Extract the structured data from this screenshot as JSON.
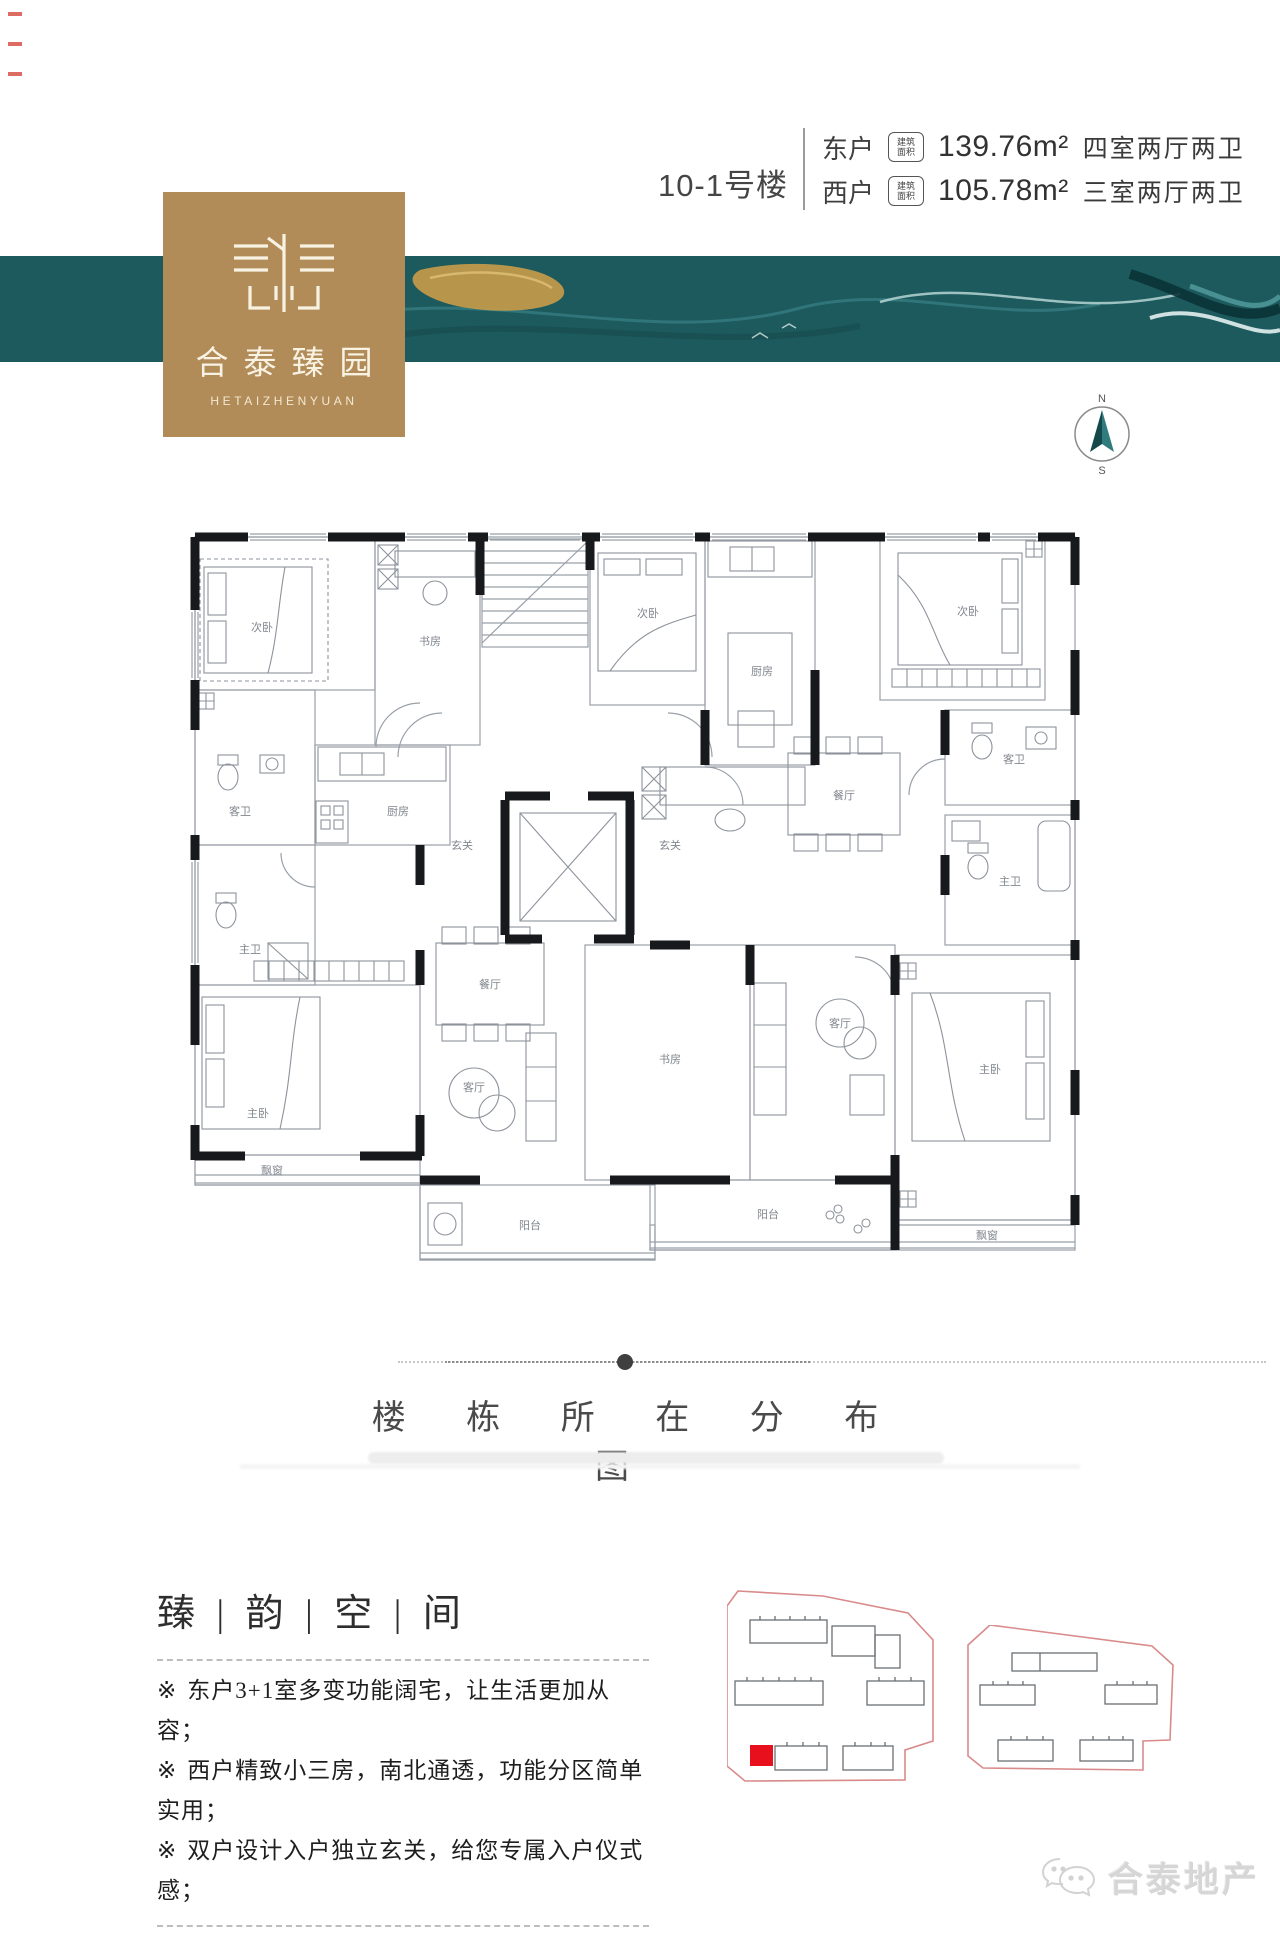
{
  "header": {
    "building_label": "10-1号楼",
    "area_badge": {
      "line1": "建筑",
      "line2": "面积",
      "dot": "m"
    },
    "units": [
      {
        "name": "东户",
        "area": "139.76m²",
        "layout": "四室两厅两卫"
      },
      {
        "name": "西户",
        "area": "105.78m²",
        "layout": "三室两厅两卫"
      }
    ]
  },
  "logo": {
    "name_cn": "合泰臻园",
    "name_en": "HETAIZHENYUAN"
  },
  "compass": {
    "north": "N",
    "south": "S"
  },
  "floorplan": {
    "rooms": [
      {
        "id": "w-bedroom2",
        "label": "次卧"
      },
      {
        "id": "w-study",
        "label": "书房"
      },
      {
        "id": "w-guest-bath",
        "label": "客卫"
      },
      {
        "id": "w-kitchen",
        "label": "厨房"
      },
      {
        "id": "w-master-bath",
        "label": "主卫"
      },
      {
        "id": "w-master-bedroom",
        "label": "主卧"
      },
      {
        "id": "w-bay-window",
        "label": "飘窗"
      },
      {
        "id": "w-dining",
        "label": "餐厅"
      },
      {
        "id": "w-living",
        "label": "客厅"
      },
      {
        "id": "w-balcony",
        "label": "阳台"
      },
      {
        "id": "w-foyer",
        "label": "玄关"
      },
      {
        "id": "e-foyer",
        "label": "玄关"
      },
      {
        "id": "e-bedroom2",
        "label": "次卧"
      },
      {
        "id": "e-kitchen",
        "label": "厨房"
      },
      {
        "id": "e-bedroom3",
        "label": "次卧"
      },
      {
        "id": "e-dining",
        "label": "餐厅"
      },
      {
        "id": "e-guest-bath",
        "label": "客卫"
      },
      {
        "id": "e-master-bath",
        "label": "主卫"
      },
      {
        "id": "e-study",
        "label": "书房"
      },
      {
        "id": "e-living",
        "label": "客厅"
      },
      {
        "id": "e-master-bedroom",
        "label": "主卧"
      },
      {
        "id": "e-bay-window",
        "label": "飘窗"
      },
      {
        "id": "e-balcony",
        "label": "阳台"
      }
    ]
  },
  "section": {
    "title": "楼 栋 所 在 分 布 图"
  },
  "features": {
    "heading": "臻 | 韵 | 空 | 间",
    "bullet": "※",
    "items": [
      "东户3+1室多变功能阔宅，让生活更加从容；",
      "西户精致小三房，南北通透，功能分区简单实用；",
      "双户设计入户独立玄关，给您专属入户仪式感；"
    ]
  },
  "footer": {
    "brand": "合泰地产"
  },
  "colors": {
    "band_teal": "#1c5a5e",
    "logo_gold": "#b28c58",
    "highlight_red": "#e8101c",
    "site_outline_pink": "#d98a8a",
    "wall_black": "#17191c"
  }
}
